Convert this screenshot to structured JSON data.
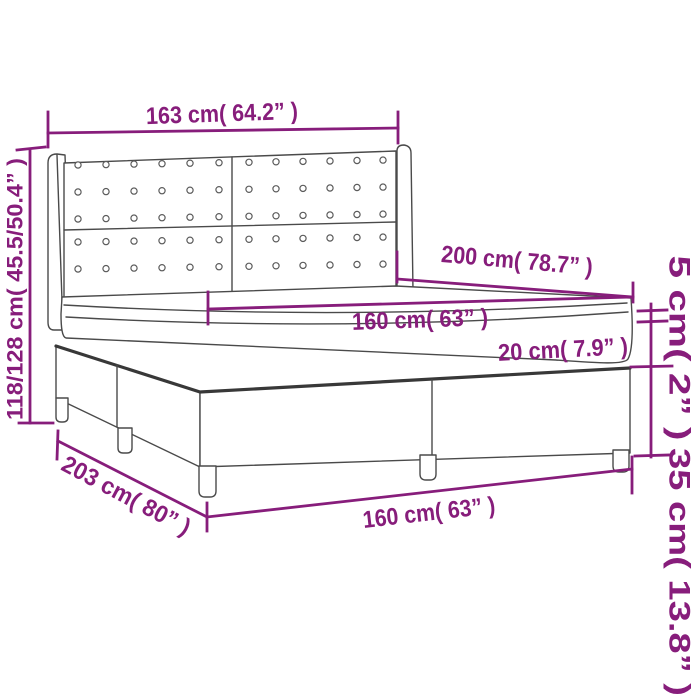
{
  "diagram": {
    "description": "Box spring bed with tufted wing headboard - dimension drawing",
    "colors": {
      "annotation": "#871D7B",
      "outline": "#4A4A4A",
      "background": "#FFFFFF"
    },
    "dimensions": {
      "headboard_width": "163 cm( 64.2” )",
      "bed_height": "118/128 cm( 45.5/50.4” )",
      "bed_length": "200 cm( 78.7” )",
      "mattress_width": "160 cm( 63” )",
      "mattress_height": "20 cm( 7.9” )",
      "topper_height": "5 cm( 2” )",
      "box_height": "35 cm( 13.8” )",
      "total_length": "203 cm( 80” )",
      "base_width": "160 cm( 63” )"
    }
  }
}
